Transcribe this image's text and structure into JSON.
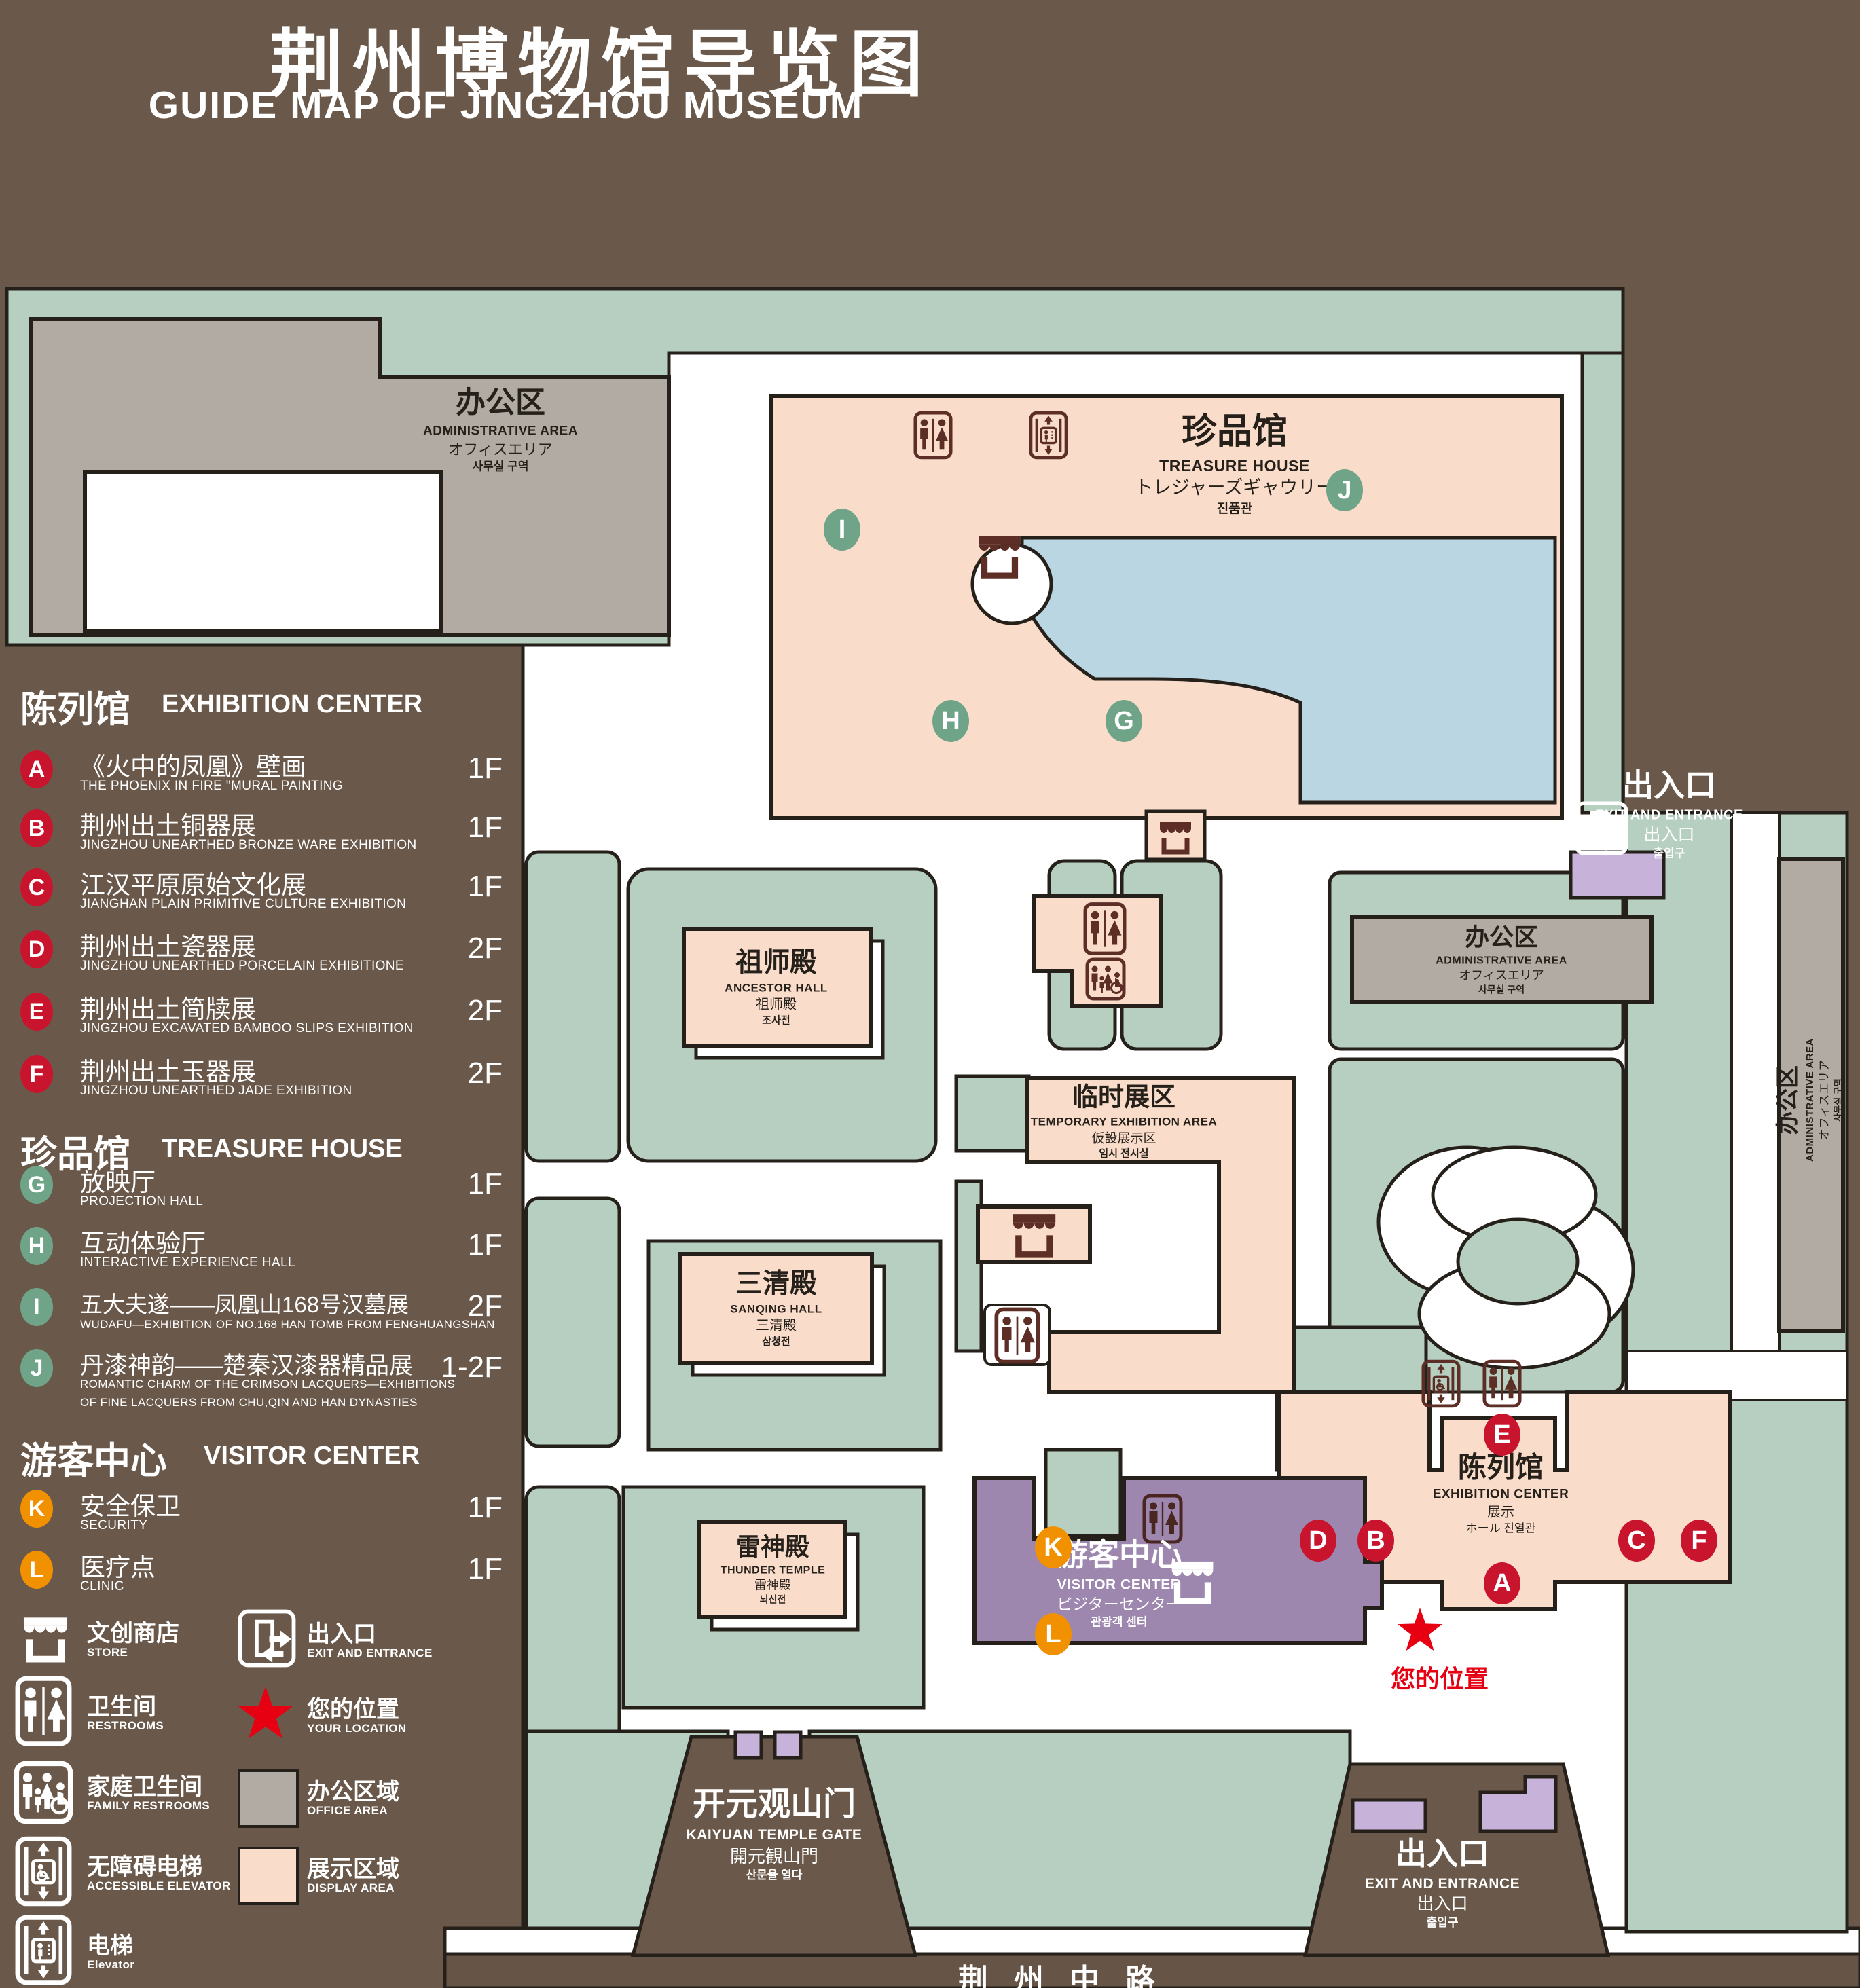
{
  "title": {
    "zh": "荆州博物馆导览图",
    "en": "GUIDE MAP OF JINGZHOU MUSEUM"
  },
  "legend": {
    "sections": [
      {
        "zh": "陈列馆",
        "en": "EXHIBITION CENTER",
        "items": [
          {
            "key": "A",
            "zh": "《火中的凤凰》壁画",
            "en": "THE PHOENIX IN FIRE \"MURAL PAINTING",
            "floor": "1F"
          },
          {
            "key": "B",
            "zh": "荆州出土铜器展",
            "en": "JINGZHOU UNEARTHED BRONZE WARE EXHIBITION",
            "floor": "1F"
          },
          {
            "key": "C",
            "zh": "江汉平原原始文化展",
            "en": "JIANGHAN PLAIN PRIMITIVE CULTURE EXHIBITION",
            "floor": "1F"
          },
          {
            "key": "D",
            "zh": "荆州出土瓷器展",
            "en": "JINGZHOU UNEARTHED PORCELAIN EXHIBITIONE",
            "floor": "2F"
          },
          {
            "key": "E",
            "zh": "荆州出土简牍展",
            "en": "JINGZHOU EXCAVATED BAMBOO SLIPS EXHIBITION",
            "floor": "2F"
          },
          {
            "key": "F",
            "zh": "荆州出土玉器展",
            "en": "JINGZHOU UNEARTHED JADE EXHIBITION",
            "floor": "2F"
          }
        ]
      },
      {
        "zh": "珍品馆",
        "en": "TREASURE HOUSE",
        "items": [
          {
            "key": "G",
            "zh": "放映厅",
            "en": "PROJECTION HALL",
            "floor": "1F"
          },
          {
            "key": "H",
            "zh": "互动体验厅",
            "en": "INTERACTIVE EXPERIENCE HALL",
            "floor": "1F"
          },
          {
            "key": "I",
            "zh": "五大夫遂——凤凰山168号汉墓展",
            "en": "WUDAFU—EXHIBITION OF NO.168 HAN TOMB FROM FENGHUANGSHAN",
            "floor": "2F"
          },
          {
            "key": "J",
            "zh": "丹漆神韵——楚秦汉漆器精品展",
            "en": "ROMANTIC CHARM OF THE CRIMSON LACQUERS—EXHIBITIONS",
            "en2": "OF FINE LACQUERS FROM CHU,QIN AND HAN DYNASTIES",
            "floor": "1-2F"
          }
        ]
      },
      {
        "zh": "游客中心",
        "en": "VISITOR CENTER",
        "items": [
          {
            "key": "K",
            "zh": "安全保卫",
            "en": "SECURITY",
            "floor": "1F"
          },
          {
            "key": "L",
            "zh": "医疗点",
            "en": "CLINIC",
            "floor": "1F"
          }
        ]
      }
    ],
    "symbols": {
      "store": {
        "zh": "文创商店",
        "en": "STORE"
      },
      "restrooms": {
        "zh": "卫生间",
        "en": "RESTROOMS"
      },
      "family": {
        "zh": "家庭卫生间",
        "en": "FAMILY RESTROOMS"
      },
      "accessible": {
        "zh": "无障碍电梯",
        "en": "ACCESSIBLE  ELEVATOR"
      },
      "elevator": {
        "zh": "电梯",
        "en": "Elevator"
      },
      "exit": {
        "zh": "出入口",
        "en": "EXIT AND ENTRANCE"
      },
      "location": {
        "zh": "您的位置",
        "en": "YOUR LOCATION"
      },
      "office": {
        "zh": "办公区域",
        "en": "OFFICE AREA"
      },
      "display": {
        "zh": "展示区域",
        "en": "DISPLAY AREA"
      }
    }
  },
  "map": {
    "buildings": {
      "admin": {
        "zh": "办公区",
        "en": "ADMINISTRATIVE AREA",
        "ja": "オフィスエリア",
        "ko": "사무실 구역"
      },
      "treasure": {
        "zh": "珍品馆",
        "en": "TREASURE HOUSE",
        "ja": "トレジャーズギャウリー",
        "ko": "진품관"
      },
      "ancestor": {
        "zh": "祖师殿",
        "en": "ANCESTOR HALL",
        "ja": "祖师殿",
        "ko": "조사전"
      },
      "temporary": {
        "zh": "临时展区",
        "en": "TEMPORARY EXHIBITION AREA",
        "ja": "仮設展示区",
        "ko": "임시 전시실"
      },
      "sanqing": {
        "zh": "三清殿",
        "en": "SANQING HALL",
        "ja": "三清殿",
        "ko": "삼청전"
      },
      "thunder": {
        "zh": "雷神殿",
        "en": "THUNDER TEMPLE",
        "ja": "雷神殿",
        "ko": "뇌신전"
      },
      "visitor": {
        "zh": "游客中心",
        "en": "VISITOR CENTER",
        "ja": "ビジターセンター",
        "ko": "관광객 센터"
      },
      "exhibition": {
        "zh": "陈列馆",
        "en": "EXHIBITION CENTER",
        "ja": "展示",
        "ko": "ホール 진열관"
      }
    },
    "gate": {
      "zh": "开元观山门",
      "en": "KAIYUAN TEMPLE GATE",
      "ja": "開元観山門",
      "ko": "산문을 열다"
    },
    "exit": {
      "zh": "出入口",
      "en": "EXIT AND ENTRANCE",
      "ja": "出入口",
      "ko": "출입구"
    },
    "road": "荆州中路",
    "your_location": "您的位置",
    "markers": {
      "A": "A",
      "B": "B",
      "C": "C",
      "D": "D",
      "E": "E",
      "F": "F",
      "G": "G",
      "H": "H",
      "I": "I",
      "J": "J",
      "K": "K",
      "L": "L"
    }
  }
}
